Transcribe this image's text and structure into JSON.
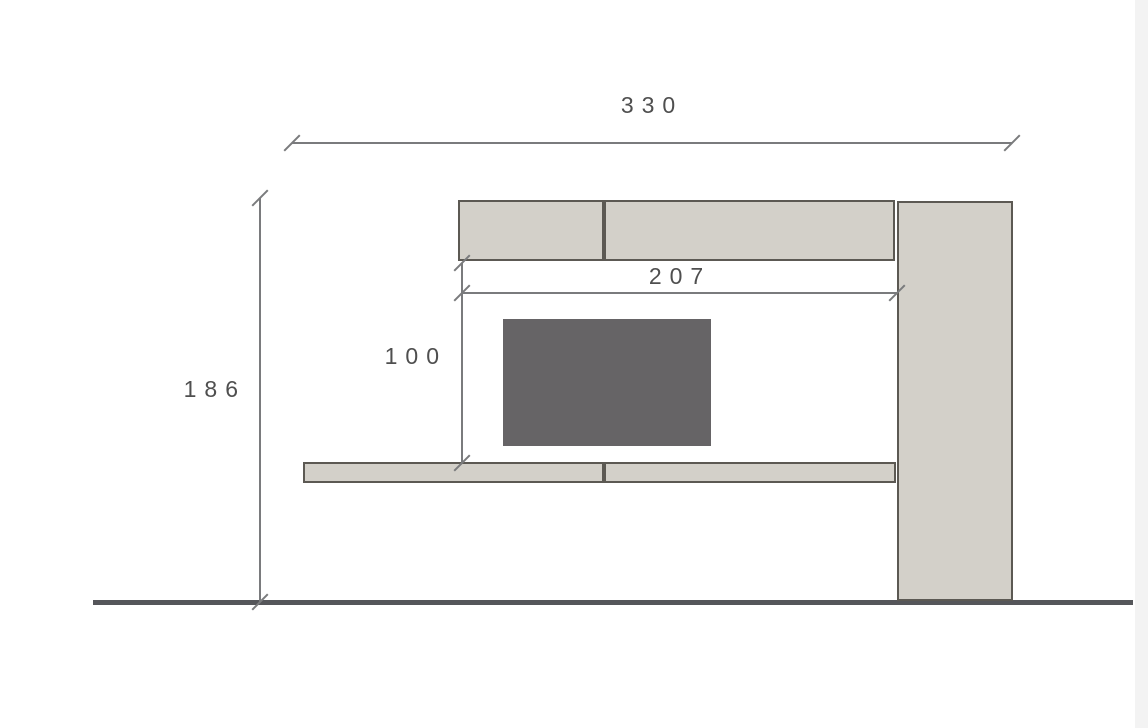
{
  "drawing": {
    "dimension_labels": {
      "total_width": "330",
      "total_height": "186",
      "niche_width": "207",
      "niche_height": "100"
    },
    "colors": {
      "page_bg": "#ffffff",
      "cabinet_fill": "#d3d0c9",
      "cabinet_border": "#5c5953",
      "tv_fill": "#666466",
      "dim_line": "#7a7b7d",
      "label_text": "#4f4f4f",
      "floor_line": "#55565a",
      "right_strip": "#f3f3f3"
    }
  }
}
